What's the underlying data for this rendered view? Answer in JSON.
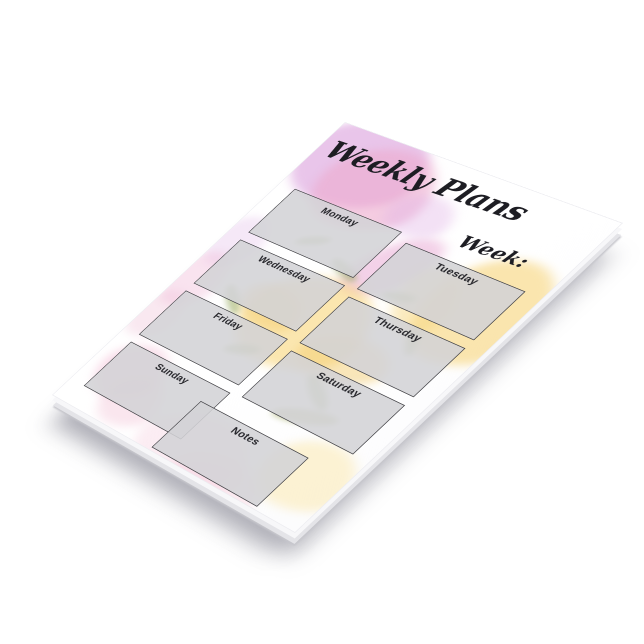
{
  "pad": {
    "title": "Weekly Plans",
    "week_label": "Week:",
    "boxes": [
      {
        "label": "Monday"
      },
      {
        "label": "Tuesday"
      },
      {
        "label": "Wednesday"
      },
      {
        "label": "Thursday"
      },
      {
        "label": "Friday"
      },
      {
        "label": "Saturday"
      },
      {
        "label": "Sunday"
      },
      {
        "label": "Notes"
      }
    ],
    "colors": {
      "paper": "#ffffff",
      "box_fill": "#d3d3d6",
      "box_border": "#47474b",
      "ink": "#1d1d23",
      "pink": "#eeaed3",
      "violet": "#d9a9dd",
      "yellow": "#f6d37e",
      "green": "#98ac60",
      "shadow": "#9a9aa6"
    }
  }
}
